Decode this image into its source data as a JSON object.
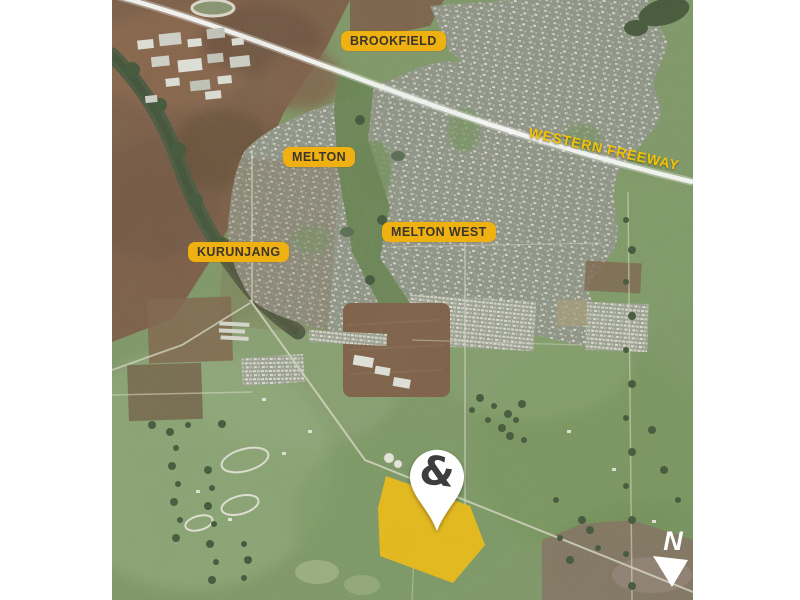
{
  "map": {
    "labels": {
      "brookfield": "BROOKFIELD",
      "melton": "MELTON",
      "melton_west": "MELTON WEST",
      "kurunjang": "KURUNJANG",
      "freeway": "WESTERN FREEWAY"
    },
    "marker": {
      "symbol": "&"
    },
    "compass": {
      "north": "N"
    },
    "colors": {
      "label_background": "#EFB011",
      "label_text": "#3A362E",
      "freeway_label_text": "#F2C307",
      "parcel_highlight": "#E8BA1E",
      "pin_fill": "#FFFFFF",
      "pin_symbol": "#3C3C3E",
      "compass": "#FFFFFF"
    }
  }
}
